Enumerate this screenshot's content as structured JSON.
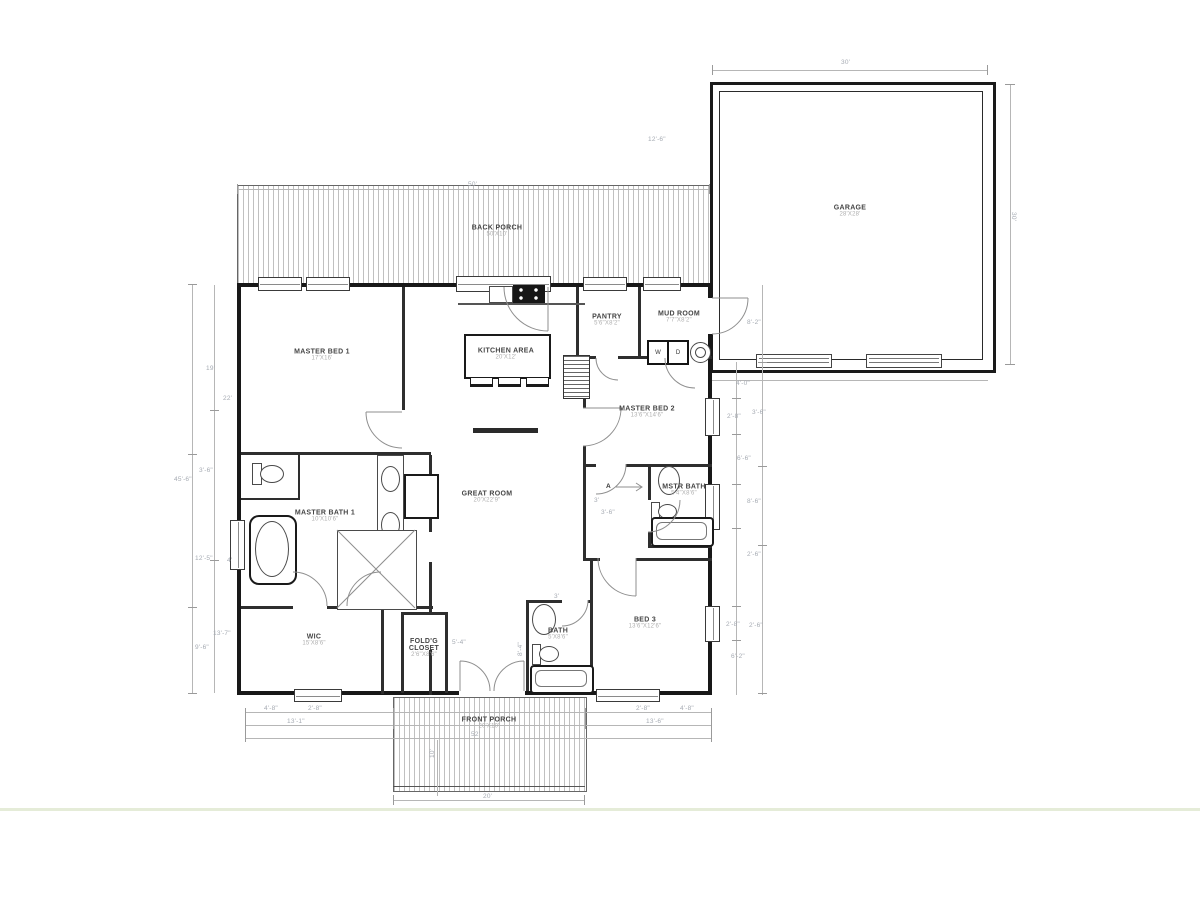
{
  "drawing": {
    "type": "residential floor plan",
    "colors": {
      "walls": "#181818",
      "interior_walls": "#2e2e2e",
      "dimension_text": "#a6abb3",
      "hatch": "#c0c0c0",
      "ground_line_green": "#e5ecd8"
    }
  },
  "rooms": {
    "garage": {
      "name": "GARAGE",
      "size": "28'X28'"
    },
    "back_porch": {
      "name": "BACK PORCH",
      "size": "50'X10'"
    },
    "master_bed_1": {
      "name": "MASTER BED 1",
      "size": "17'X16'"
    },
    "kitchen": {
      "name": "KITCHEN AREA",
      "size": "20'X12'"
    },
    "pantry": {
      "name": "PANTRY",
      "size": "5'6\"X8'2\""
    },
    "mud_room": {
      "name": "MUD ROOM",
      "size": "7'7\"X8'2\""
    },
    "master_bed_2": {
      "name": "MASTER BED 2",
      "size": "13'6\"X14'6\""
    },
    "great_room": {
      "name": "GREAT ROOM",
      "size": "20'X22'9\""
    },
    "master_bath_1": {
      "name": "MASTER BATH 1",
      "size": "10'X10'6\""
    },
    "master_bath_2": {
      "name": "MSTR BATH",
      "size": "5'4\"X8'6\""
    },
    "wic": {
      "name": "WIC",
      "size": "15'X8'6\""
    },
    "foldg_closet": {
      "name": "FOLD'G CLOSET",
      "size": "2'6\"X8'6\""
    },
    "bath": {
      "name": "BATH",
      "size": "5'X8'6\""
    },
    "bed_3": {
      "name": "BED 3",
      "size": "13'6\"X12'6\""
    },
    "front_porch": {
      "name": "FRONT PORCH",
      "size": "20'X10'"
    }
  },
  "appliances": {
    "washer": "W",
    "dryer": "D"
  },
  "markers": {
    "attic": "A"
  },
  "dims": [
    "30'",
    "30'",
    "12'-6\"",
    "50'",
    "45'-6\"",
    "19'",
    "22'",
    "3'-6\"",
    "12'-5\"",
    "4'",
    "13'-7\"",
    "9'-6\"",
    "8'-2\"",
    "4'-0\"",
    "2'-8\"",
    "3'-6\"",
    "6'-6\"",
    "8'-6\"",
    "2'-6\"",
    "2'-8\"",
    "2'-6\"",
    "6'-2\"",
    "4'-8\"",
    "2'-8\"",
    "2'-8\"",
    "4'-8\"",
    "13'-1\"",
    "13'-6\"",
    "52'",
    "20'",
    "10'",
    "5'-4\"",
    "3'",
    "3'-6\"",
    "3'",
    "8'-4\""
  ]
}
